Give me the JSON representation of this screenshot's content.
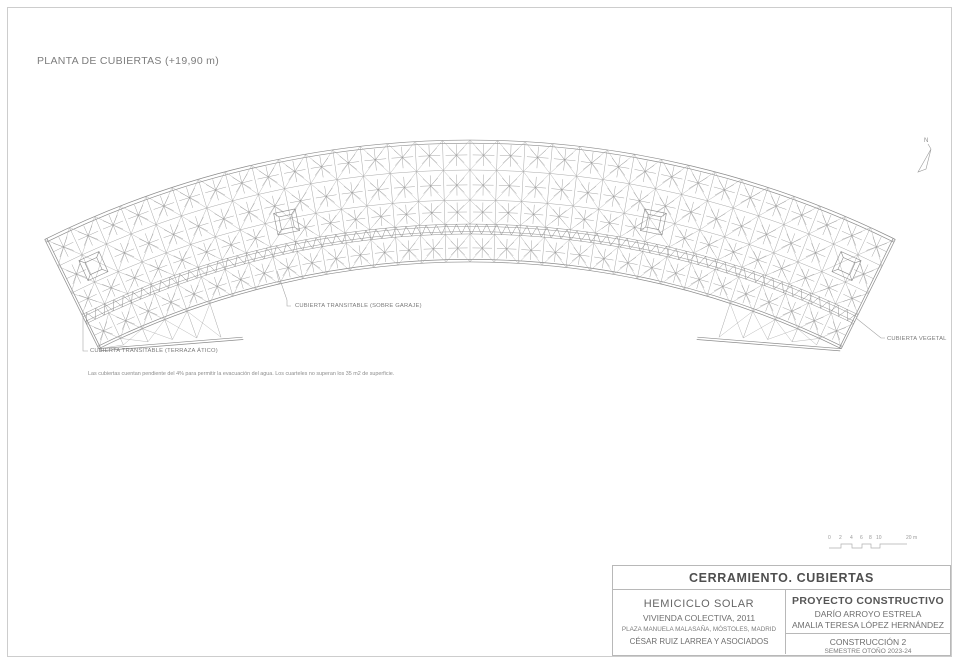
{
  "page": {
    "title": "PLANTA DE CUBIERTAS (+19,90 m)"
  },
  "labels": {
    "attic": "CUBIERTA TRANSITABLE (TERRAZA ÁTICO)",
    "garage": "CUBIERTA TRANSITABLE (SOBRE GARAJE)",
    "green": "CUBIERTA VEGETAL",
    "note": "Las cubiertas cuentan pendiente del 4% para permitir la evacuación del agua. Los cuarteles no superan los 35 m2 de superficie."
  },
  "compass": {
    "label": "N"
  },
  "scalebar": {
    "ticks": [
      "0",
      "2",
      "4",
      "6",
      "8",
      "10"
    ],
    "end_label": "20 m"
  },
  "titleblock": {
    "sheet_title": "CERRAMIENTO. CUBIERTAS",
    "project": {
      "name": "HEMICICLO SOLAR",
      "subtitle": "VIVIENDA COLECTIVA, 2011",
      "address": "PLAZA MANUELA MALASAÑA, MÓSTOLES, MADRID",
      "architect": "CÉSAR RUIZ LARREA Y ASOCIADOS"
    },
    "course": {
      "type": "PROYECTO CONSTRUCTIVO",
      "author1": "DARÍO ARROYO ESTRELA",
      "author2": "AMALIA TERESA LÓPEZ HERNÁNDEZ",
      "subject": "CONSTRUCCIÓN 2",
      "term": "SEMESTRE OTOÑO 2023-24"
    }
  },
  "drawing": {
    "cx": 470,
    "cy": 1100,
    "r_outer": 960,
    "r_inner": 838,
    "half_angle_deg": 26.3,
    "cols": 32,
    "row_radii": [
      [
        960,
        930
      ],
      [
        930,
        900
      ],
      [
        900,
        876
      ],
      [
        866,
        838
      ]
    ],
    "strip": {
      "r_out": 876,
      "r_in": 866
    },
    "wedge": {
      "r_end": 796,
      "theta_inner_deg": 16.6
    },
    "skylights": [
      {
        "deg": -24.3,
        "r": 915
      },
      {
        "deg": -11.8,
        "r": 897
      },
      {
        "deg": 11.8,
        "r": 897
      },
      {
        "deg": 24.3,
        "r": 915
      }
    ],
    "colors": {
      "edge": "#8c8c8c",
      "grid": "#9e9e9e",
      "diag": "#a8a8a8",
      "star": "#9b9b9b",
      "hatch": "#8f8f8f",
      "leader": "#a0a0a0",
      "scalebar": "#b0b0b0",
      "north": "#9b9b9b"
    }
  }
}
